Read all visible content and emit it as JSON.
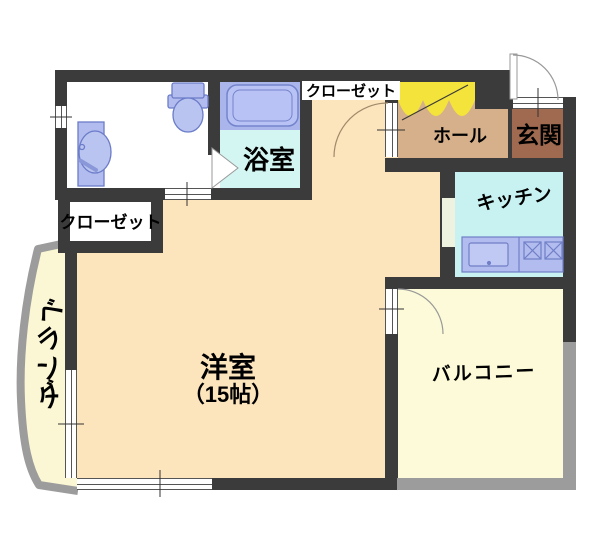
{
  "rooms": {
    "western_room": {
      "name": "洋室",
      "size": "（15帖）"
    },
    "bathroom": {
      "name": "浴室"
    },
    "kitchen": {
      "name": "キッチン"
    },
    "hall": {
      "name": "ホール"
    },
    "entrance": {
      "name": "玄関"
    },
    "hall_closet": {
      "name": "クローゼット"
    },
    "west_closet": {
      "name": "クローゼット"
    },
    "balcony": {
      "name": "バルコニー"
    },
    "veranda": {
      "name": "ベランダ"
    }
  },
  "colors": {
    "wall": "#3b3b3b",
    "western_room_floor": "#fce4bd",
    "hall_floor": "#d5b08a",
    "entrance_floor": "#a06a50",
    "closet_door_yellow": "#f3e33b",
    "kitchen_floor": "#c8f2f2",
    "bathroom_floor": "#d3f6f3",
    "bathtub_zone": "#aab5ec",
    "fixture_blue": "#b2bcee",
    "balcony_floor": "#fcfad8",
    "veranda_floor": "#fbf7d4",
    "railing_gray": "#9c9c9c"
  }
}
